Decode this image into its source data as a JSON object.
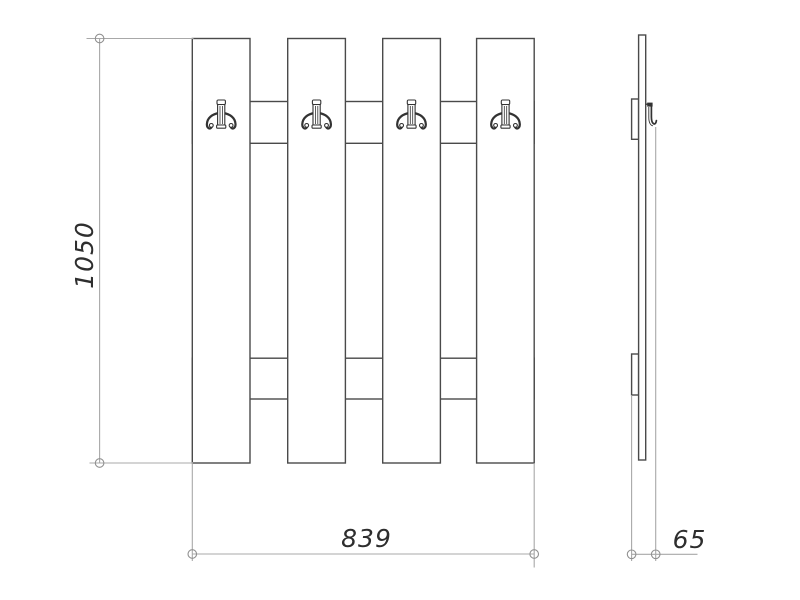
{
  "drawing": {
    "kind": "technical-drawing",
    "views": {
      "front": {
        "slat_count": 4,
        "hook_count": 4,
        "rail_count": 2
      },
      "side": {
        "hook_count": 1,
        "rail_count": 2
      }
    },
    "dimensions": {
      "height": "1050",
      "width": "839",
      "depth": "65"
    },
    "colors": {
      "background": "#ffffff",
      "outline": "#4a4a4a",
      "dimension_line": "#a8a8a8",
      "dimension_marker": "#909090",
      "hook": "#333333",
      "text": "#2e2e2e"
    },
    "icons": {
      "front_hook": "double-coat-hook-icon",
      "side_hook": "coat-hook-profile-icon",
      "dimension_endpoint": "circle-marker"
    }
  }
}
